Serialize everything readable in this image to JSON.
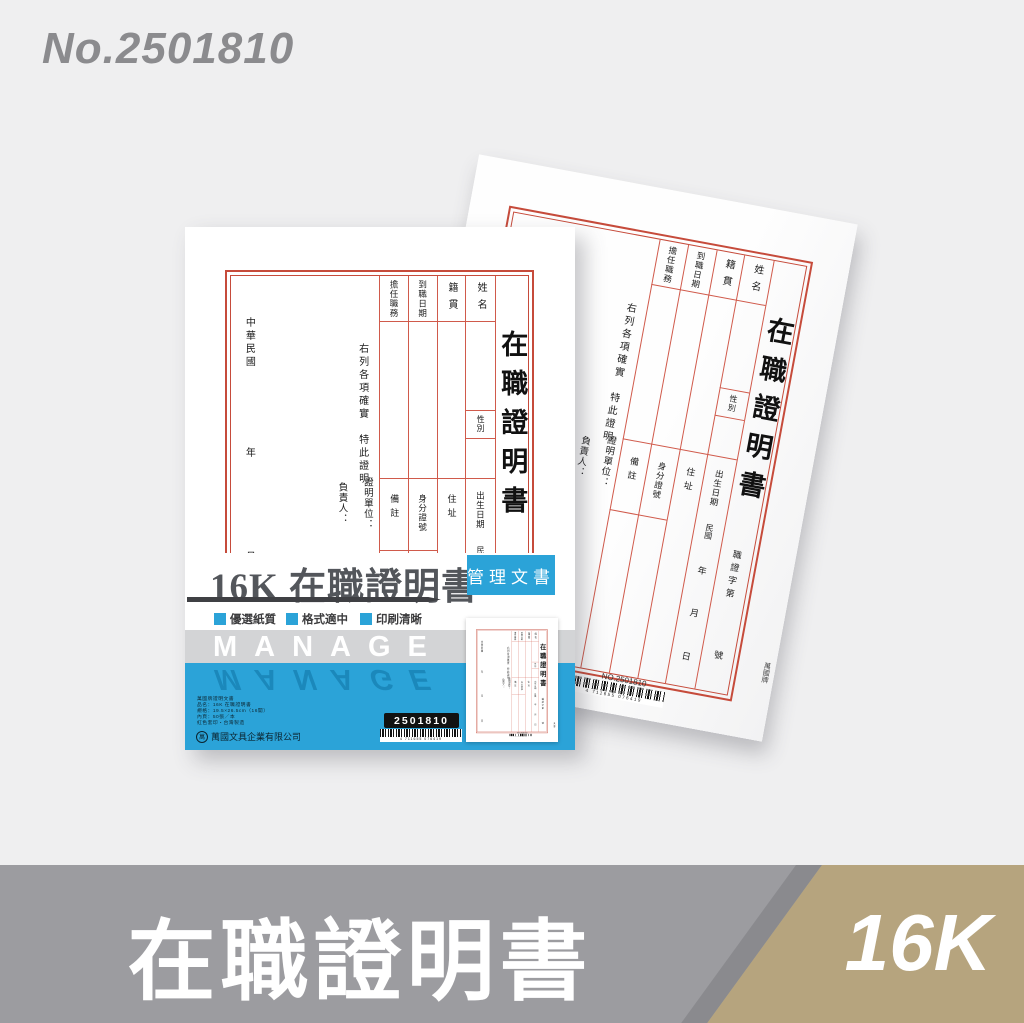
{
  "page": {
    "catalog_no": "No.2501810"
  },
  "form": {
    "title": "在職證明書",
    "col_name": "姓名",
    "col_origin": "籍貫",
    "col_join_date": "到職日期",
    "col_position": "擔任職務",
    "sex": "性別",
    "birth_date": "出生日期",
    "era": "民國",
    "year": "年",
    "month": "月",
    "day": "日",
    "address": "住址",
    "id_number": "身分證號",
    "remarks": "備註",
    "certify_text": "右列各項確實　特此證明",
    "cert_no_prefix": "職證字第",
    "cert_no_suffix": "號",
    "issuer_label": "證明單位：",
    "manager_label": "負責人：",
    "roc_era": "中華民國",
    "footer_no": "NO.2501810",
    "barcode_digits": "4 711655 076419",
    "brand": "萬國牌"
  },
  "package": {
    "title": "16K 在職證明書",
    "badge": "管理文書",
    "tags": [
      "優選紙質",
      "格式適中",
      "印刷清晰"
    ],
    "brand_en": "MANAGE",
    "info_lines": [
      "萬國牌證明文書",
      "品名：16K 在職證明書",
      "規格：19.5×26.5cm（16開）",
      "內頁：50張／本",
      "紅色套印・台灣製造"
    ],
    "company_mark": "萬",
    "company": "萬國文具企業有限公司",
    "item_code": "2501810",
    "barcode_digits": "4 711655 076419"
  },
  "banner": {
    "title": "在職證明書",
    "size_label": "16K"
  },
  "colors": {
    "accent_blue": "#2BA3D8",
    "form_red": "#C64B3B",
    "banner_gray": "#9C9CA0",
    "banner_gold": "#B6A47E"
  }
}
